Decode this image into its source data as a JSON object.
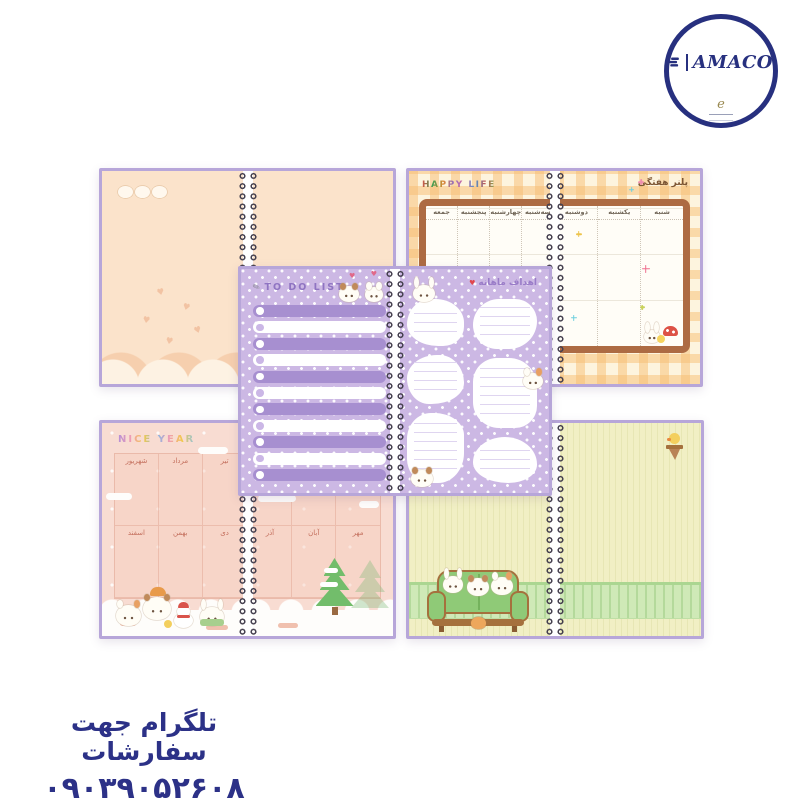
{
  "brand": {
    "name": "AMACO",
    "signature": "e"
  },
  "contact": {
    "telegram_label": "تلگرام جهت سفارشات",
    "phone": "۰۹۰۳۹۰۵۲۶۰۸"
  },
  "icons": {
    "heart": "♥",
    "pencil": "✎"
  },
  "spreads": {
    "weekly": {
      "title_en": "HAPPY LIFE",
      "title_fa": "پلنر هفتگی",
      "days_first_page": [
        "شنبه",
        "یکشنبه",
        "دوشنبه"
      ],
      "days_second_page": [
        "سه‌شنبه",
        "چهارشنبه",
        "پنجشنبه",
        "جمعه"
      ]
    },
    "todo": {
      "title": "TO DO LIST",
      "row_count": 11
    },
    "monthly_goals": {
      "title": "اهداف ماهانه"
    },
    "year": {
      "title": "NICE YEAR",
      "months_left_page_row1": [
        "تیر",
        "مرداد",
        "شهریور"
      ],
      "months_left_page_row2": [
        "دی",
        "بهمن",
        "اسفند"
      ],
      "months_right_page_row2": [
        "مهر",
        "آبان",
        "آذر"
      ]
    }
  },
  "colors": {
    "navy": "#27307f",
    "cover_purple": "#b7a6d9",
    "peach_page": "#fbe3cb",
    "gingham_orange": "#f6bd72",
    "frame_brown": "#ad6b43",
    "purple_page": "#ccb8e4",
    "purple_bar": "#a78fd0",
    "pink_page": "#f8dcd2",
    "month_text": "#c4705e",
    "green_page": "#f1efc4",
    "fence_green": "#cfe9b7",
    "contact_text": "#2c3187"
  }
}
